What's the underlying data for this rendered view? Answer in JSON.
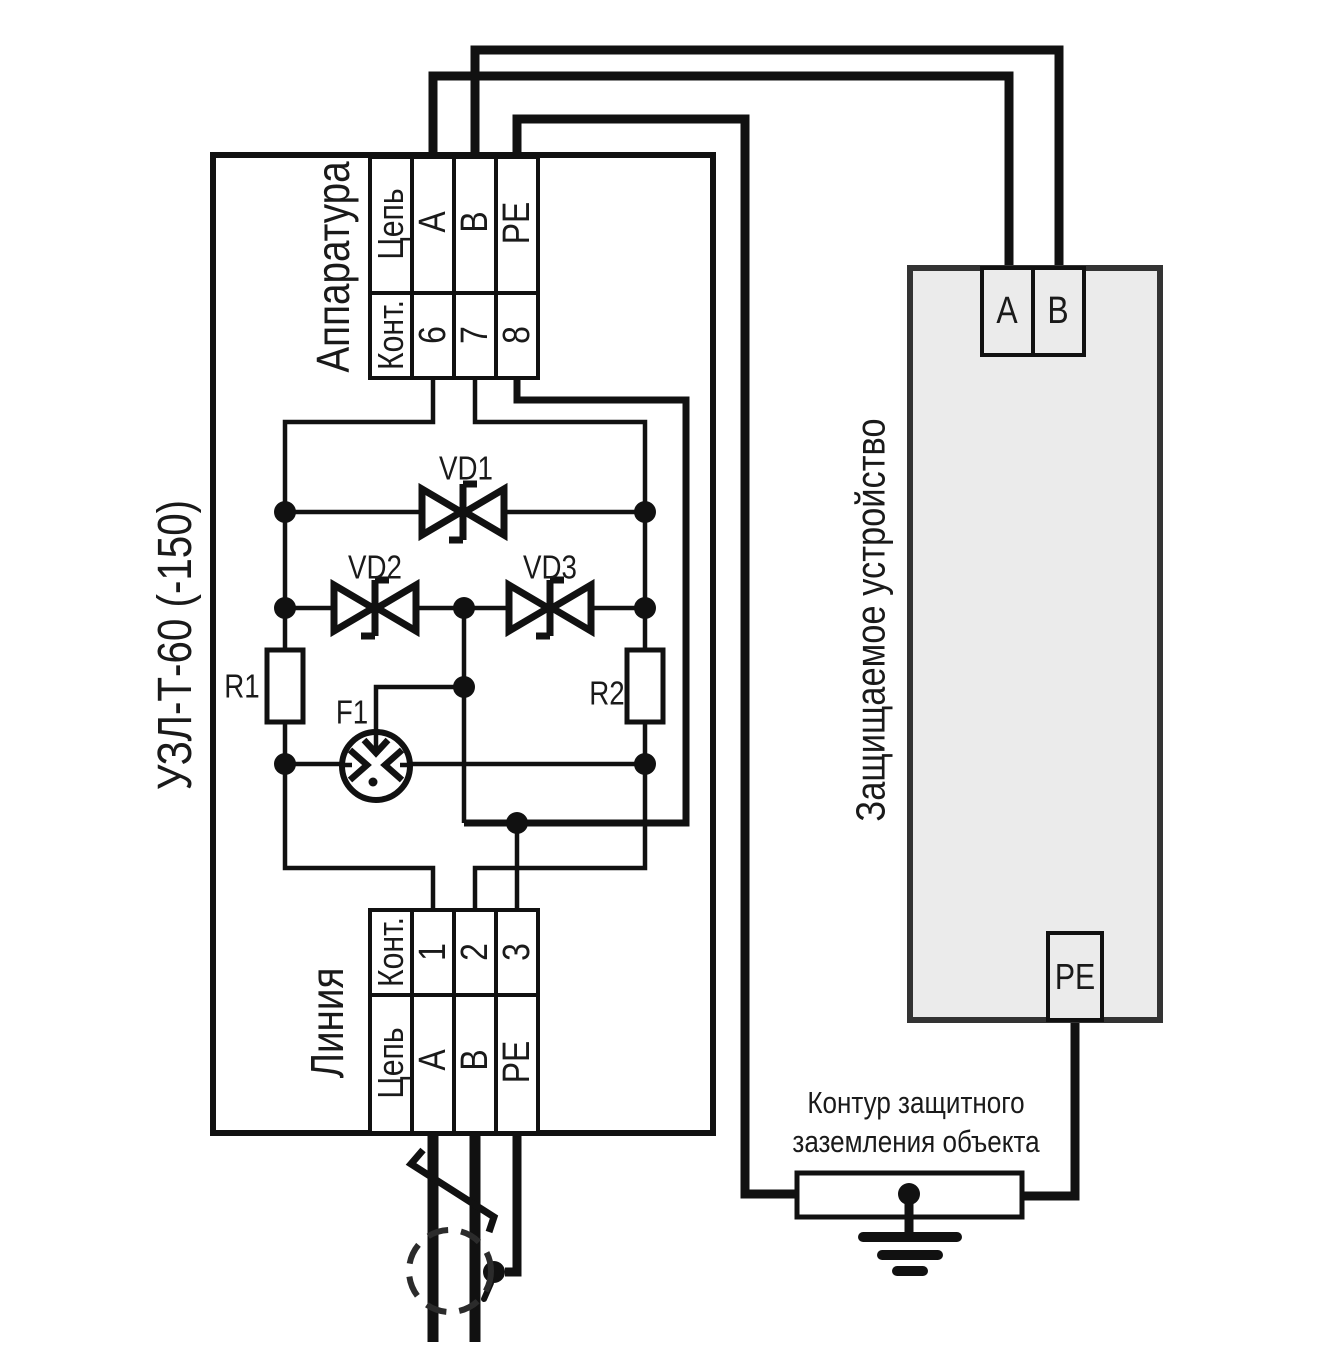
{
  "schematic": {
    "uzl": {
      "title": "УЗЛ-Т-60 (-150)",
      "apparatus_block": {
        "label": "Аппаратура",
        "circuit_header": "Цепь",
        "contact_header": "Конт.",
        "terminals": [
          {
            "circuit": "A",
            "contact": "6"
          },
          {
            "circuit": "B",
            "contact": "7"
          },
          {
            "circuit": "PE",
            "contact": "8"
          }
        ]
      },
      "line_block": {
        "label": "Линия",
        "circuit_header": "Цепь",
        "contact_header": "Конт.",
        "terminals": [
          {
            "circuit": "A",
            "contact": "1"
          },
          {
            "circuit": "B",
            "contact": "2"
          },
          {
            "circuit": "PE",
            "contact": "3"
          }
        ]
      },
      "components": {
        "vd1": "VD1",
        "vd2": "VD2",
        "vd3": "VD3",
        "r1": "R1",
        "r2": "R2",
        "f1": "F1"
      }
    },
    "protected_device": {
      "label": "Защищаемое устройство",
      "terminal_a": "A",
      "terminal_b": "B",
      "terminal_pe": "PE"
    },
    "ground": {
      "label_line1": "Контур защитного",
      "label_line2": "заземления объекта"
    },
    "colors": {
      "background": "#ffffff",
      "line": "#111111",
      "device_fill": "#ebebeb",
      "device_border": "#333333",
      "text": "#1a1a1a"
    }
  }
}
